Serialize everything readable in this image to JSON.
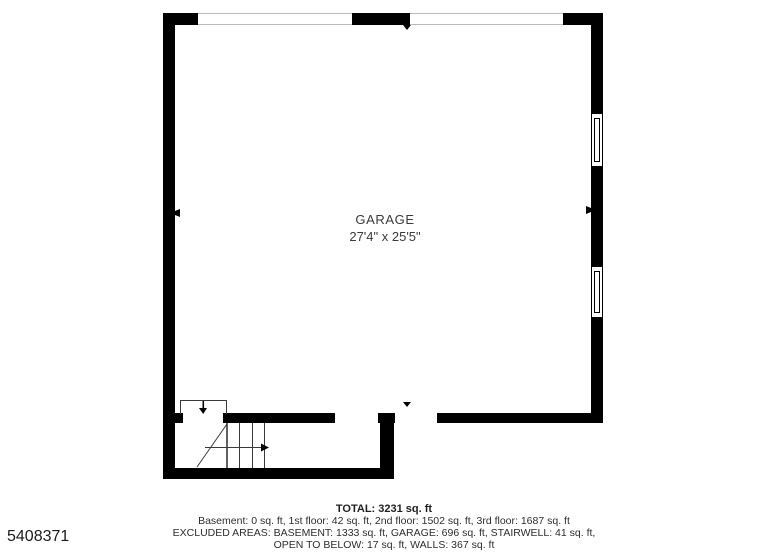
{
  "floor_plan": {
    "room": {
      "name": "GARAGE",
      "dimensions": "27'4\" x 25'5\""
    },
    "features": [
      "garage-door-openings-top",
      "window-right-upper",
      "window-right-lower",
      "stairwell-bottom-left",
      "door-opening-bottom"
    ]
  },
  "summary": {
    "total": "TOTAL: 3231 sq. ft",
    "floors": "Basement: 0 sq. ft, 1st floor: 42 sq. ft, 2nd floor: 1502 sq. ft, 3rd floor: 1687 sq. ft",
    "excluded_line1": "EXCLUDED AREAS: BASEMENT: 1333 sq. ft, GARAGE: 696 sq. ft, STAIRWELL: 41 sq. ft,",
    "excluded_line2": "OPEN TO BELOW: 17 sq. ft, WALLS: 367 sq. ft"
  },
  "listing_id": "5408371",
  "colors": {
    "wall": "#000000",
    "opening_line": "#bbbbbb",
    "stair_line": "#3a3a3a",
    "label_text": "#3b3b3b",
    "summary_text": "#2e2e2e"
  }
}
